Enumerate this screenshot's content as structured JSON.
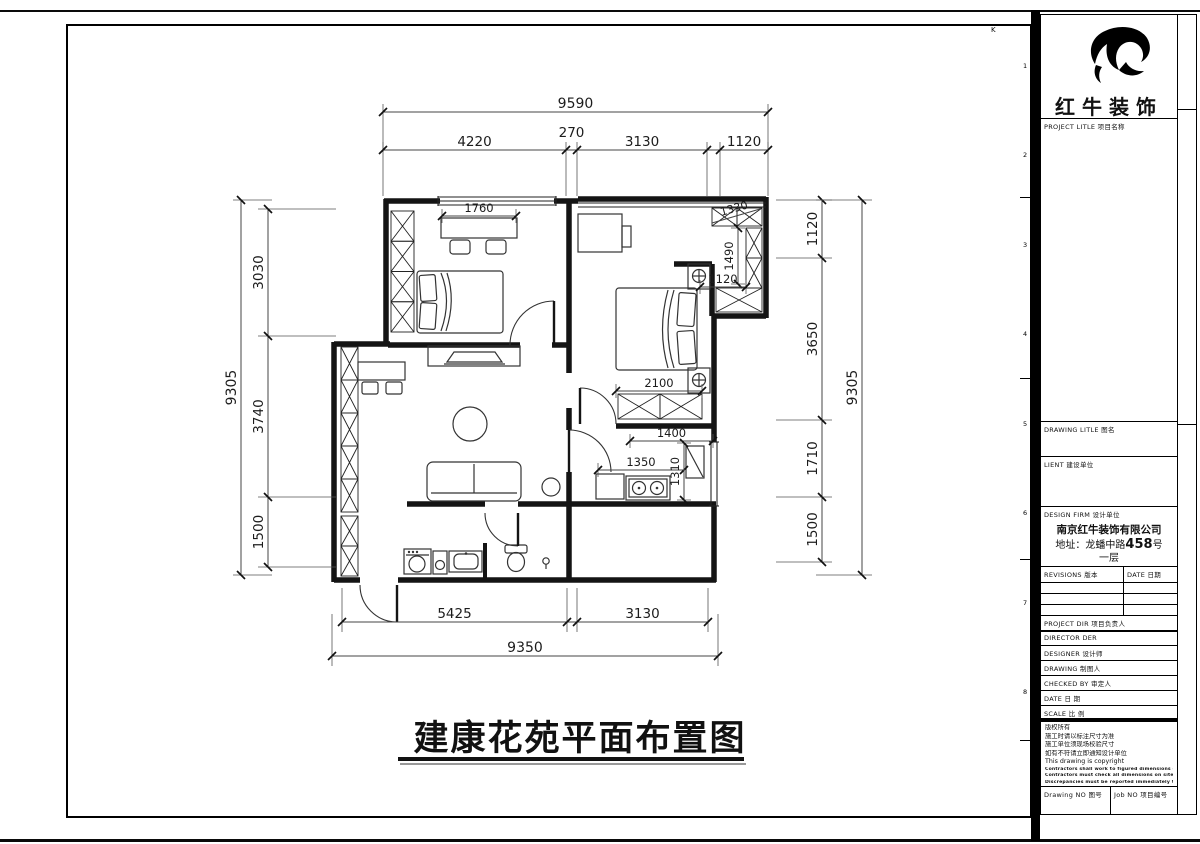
{
  "drawing": {
    "title": "建康花苑平面布置图"
  },
  "plan": {
    "dims": {
      "top_overall": "9590",
      "top_segments": [
        "4220",
        "270",
        "3130",
        "",
        "1120"
      ],
      "left_overall": "9305",
      "left_segments": [
        "3030",
        "3740",
        "1500"
      ],
      "right_overall": "9305",
      "right_segments": [
        "1120",
        "3650",
        "1710",
        "1500"
      ],
      "bottom_overall": "9350",
      "bottom_segments": [
        "5425",
        "",
        "3130"
      ],
      "interior": {
        "desk_width": "1760",
        "bed_width": "2100",
        "kitchen_top": "1400",
        "kitchen_counter": "1350",
        "kitchen_depth": "1310",
        "closet_depth": "1490",
        "closet_width": "1120",
        "closet_top": "1330"
      }
    }
  },
  "title_block": {
    "brand": "红牛装饰",
    "project_title_label": "PROJECT LITLE  项目名称",
    "drawing_title_label": "DRAWING LITLE  图名",
    "client_label": "LIENT  建设单位",
    "design_firm_label": "DESIGN FIRM  设计单位",
    "firm": {
      "name": "南京红牛装饰有限公司",
      "address_prefix": "地址：龙蟠中路",
      "address_number": "458",
      "address_suffix": "号一层"
    },
    "revisions_label": "REVISIONS  版本",
    "date_label": "DATE  日期",
    "project_dir_label": "PROJECT DIR    项目负责人",
    "director_label": "DIRECTOR DER",
    "designer_label": "DESIGNER       设计师",
    "drawing_label": "DRAWING        制图人",
    "checked_label": "CHECKED BY     审定人",
    "date2_label": "DATE           日 期",
    "scale_label": "SCALE          比 例",
    "copyright": [
      "版权所有",
      "施工时请以标注尺寸为准",
      "施工单位须现场校验尺寸",
      "如有不符请立即通知设计单位",
      "This drawing is copyright",
      "Contractors shall work to figured dimensions only",
      "Contractors must check all dimensions on site",
      "Discrepancies must be reported immediately to architects"
    ],
    "drawing_no_label": "Drawing NO  图号",
    "job_no_label": "Job NO  项目编号"
  },
  "sheet": {
    "corner_mark": "K",
    "ruler_numbers": [
      "1",
      "2",
      "3",
      "4",
      "5",
      "6",
      "7",
      "8"
    ]
  }
}
